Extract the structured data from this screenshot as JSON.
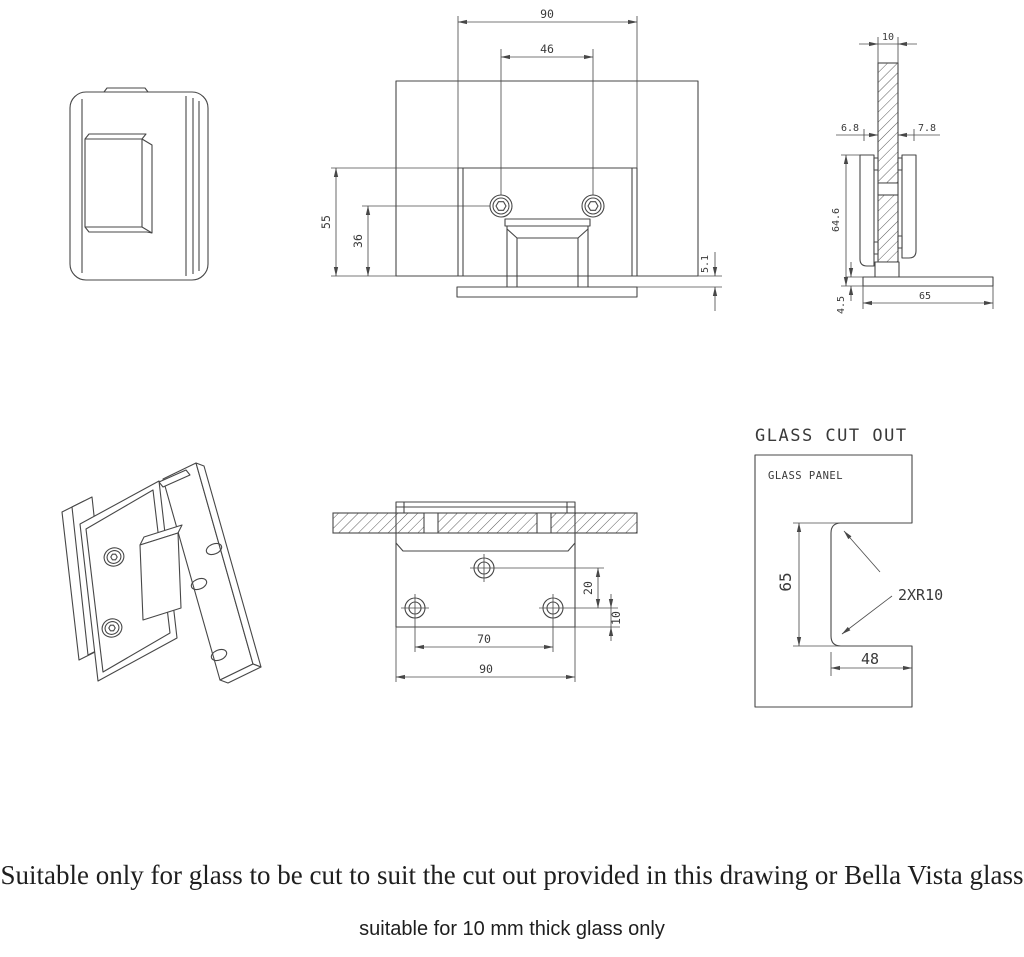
{
  "title": "Glass hinge technical drawing",
  "colors": {
    "line": "#474747",
    "text": "#3a3a3a",
    "background": "#ffffff"
  },
  "views": {
    "front": {
      "dim_width": "90",
      "dim_hole_spacing": "46",
      "dim_height": "55",
      "dim_hole_height": "36",
      "dim_base_gap": "5.1"
    },
    "side": {
      "dim_glass_thickness": "10",
      "dim_offset_left": "6.8",
      "dim_offset_right": "7.8",
      "dim_height": "64.6",
      "dim_base_thickness": "4.5",
      "dim_base_width": "65"
    },
    "plan": {
      "dim_top_hole_offset": "20",
      "dim_bottom_hole_offset": "10",
      "dim_hole_spacing": "70",
      "dim_width": "90"
    },
    "cutout": {
      "title": "GLASS CUT OUT",
      "panel_label": "GLASS PANEL",
      "dim_height": "65",
      "dim_depth": "48",
      "dim_radius": "2XR10"
    }
  },
  "notes": {
    "line1": "Suitable only for glass to be cut to suit the cut out provided in this drawing or Bella Vista glass",
    "line2": "suitable for 10 mm thick glass only"
  }
}
